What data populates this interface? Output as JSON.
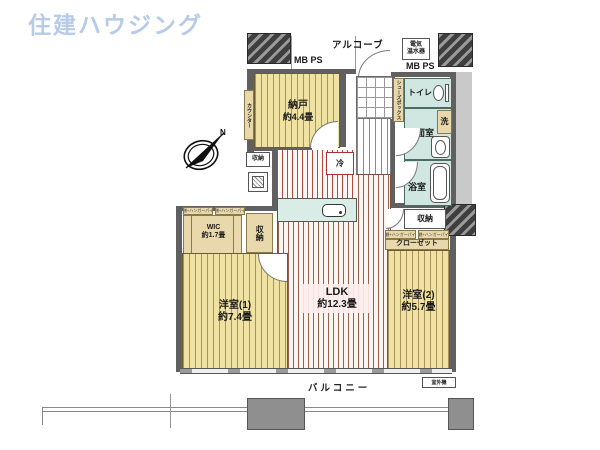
{
  "logo": "住建ハウジング",
  "compass_n": "N",
  "top": {
    "mbps_left": "MB PS",
    "alcove": "アルコーブ",
    "heater_line1": "電気",
    "heater_line2": "温水器",
    "mbps_right": "MB PS"
  },
  "rooms": {
    "nando_name": "納戸",
    "nando_size": "約4.4畳",
    "counter": "カウンター",
    "shoebox": "シューズボックス",
    "toilet": "トイレ",
    "laundry": "洗",
    "washroom": "洗面室",
    "bathroom": "浴室",
    "fridge": "冷",
    "storage_kitchen": "収納",
    "storage_left": "収納",
    "storage_right": "収納",
    "wic_name": "WIC",
    "wic_size": "約1.7畳",
    "shelf_note": "枕棚+ハンガーパイプ",
    "closet": "クローゼット",
    "ldk_name": "LDK",
    "ldk_size": "約12.3畳",
    "west1_name": "洋室(1)",
    "west1_size": "約7.4畳",
    "west2_name": "洋室(2)",
    "west2_size": "約5.7畳",
    "balcony": "バルコニー",
    "outdoor_unit": "室外機"
  },
  "colors": {
    "logo_blue": "#b7cbe9",
    "tatami_yellow": "#efe2a2",
    "ldk_stripe": "#96604f",
    "wet_teal": "#cfe7e0",
    "closet_tan": "#e9d8ab",
    "wall_gray": "#606060"
  }
}
